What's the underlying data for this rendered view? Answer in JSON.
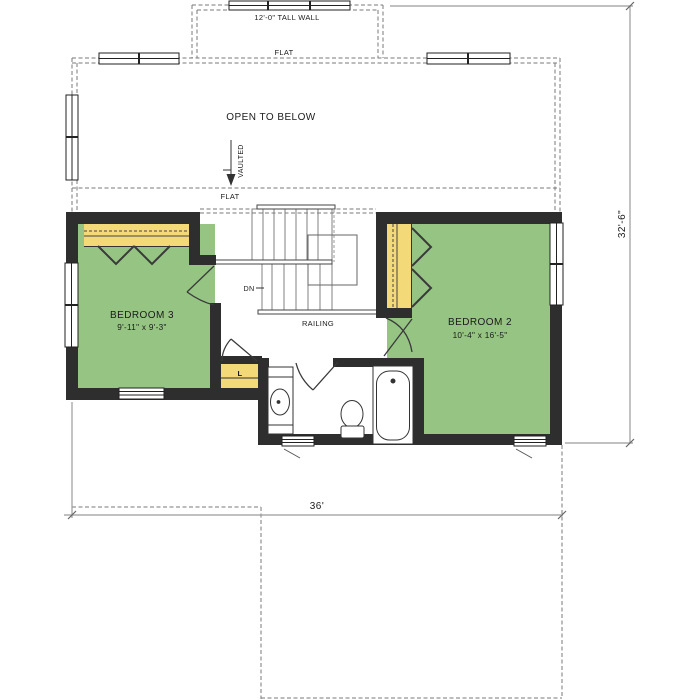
{
  "plan": {
    "labels": {
      "tall_wall": "12'-0\" TALL WALL",
      "flat_upper": "FLAT",
      "flat_lower": "FLAT",
      "open_to_below": "OPEN TO BELOW",
      "vaulted": "VAULTED",
      "dn": "DN",
      "railing": "RAILING",
      "linen": "L"
    },
    "rooms": [
      {
        "id": "bedroom3",
        "name": "BEDROOM 3",
        "size": "9'-11\" x 9'-3\""
      },
      {
        "id": "bedroom2",
        "name": "BEDROOM 2",
        "size": "10'-4\" x 16'-5\""
      }
    ],
    "dimensions": {
      "overall_depth": "32'-6\"",
      "overall_width": "36'"
    },
    "colors": {
      "room_fill_green": "#95c483",
      "closet_fill_yellow": "#f3d977",
      "wall_dark": "#2e2e2e",
      "dashed_line_grey": "#7a7a7a",
      "dimension_line_grey": "#9b9b9b"
    }
  }
}
